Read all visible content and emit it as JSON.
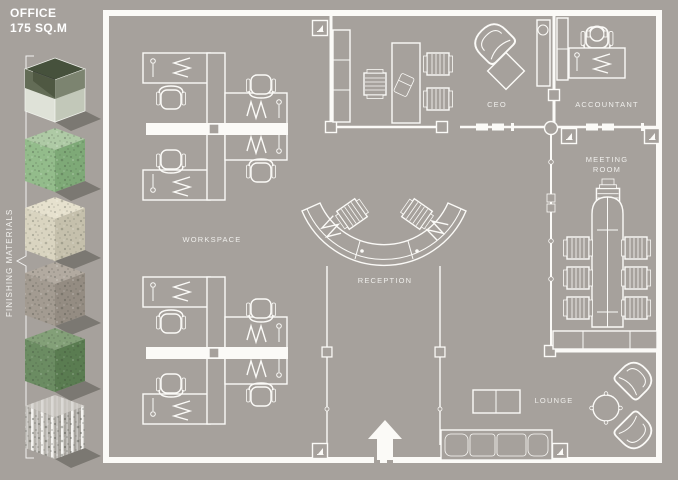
{
  "window": {
    "bg": "#a6a19c"
  },
  "title": {
    "line1": "OFFICE",
    "line2": "175 SQ.M"
  },
  "sidebar": {
    "walls_label": "WALLS",
    "finishing_label": "FINISHING MATERIALS",
    "floor_label": "FLOOR",
    "cubes": [
      {
        "name": "glass-cube",
        "top": "#46513c",
        "left": "#dfe2d8",
        "right": "#c2c8b9",
        "band": "#4d573f"
      },
      {
        "name": "green-terrazzo-cube",
        "top": "#aecaa5",
        "left": "#93bc8b",
        "right": "#7ea977"
      },
      {
        "name": "cream-terrazzo-cube",
        "top": "#e6e1ce",
        "left": "#d9d4c0",
        "right": "#c5c0ac"
      },
      {
        "name": "gray-concrete-cube",
        "top": "#b2aaa0",
        "left": "#a39b91",
        "right": "#948c82"
      },
      {
        "name": "dark-green-terrazzo-cube",
        "top": "#83a078",
        "left": "#6b8c62",
        "right": "#5a7c51"
      },
      {
        "name": "striped-terrazzo-cube",
        "top": "#c7c4be",
        "left": "#b6b3ad",
        "right": "#a8a59f"
      }
    ]
  },
  "plan": {
    "wall_color": "#fbfaf7",
    "labels": {
      "workspace": "WORKSPACE",
      "reception": "RECEPTION",
      "ceo": "CEO",
      "accountant": "ACCOUNTANT",
      "meeting_room": "MEETING ROOM",
      "lounge": "LOUNGE"
    }
  }
}
